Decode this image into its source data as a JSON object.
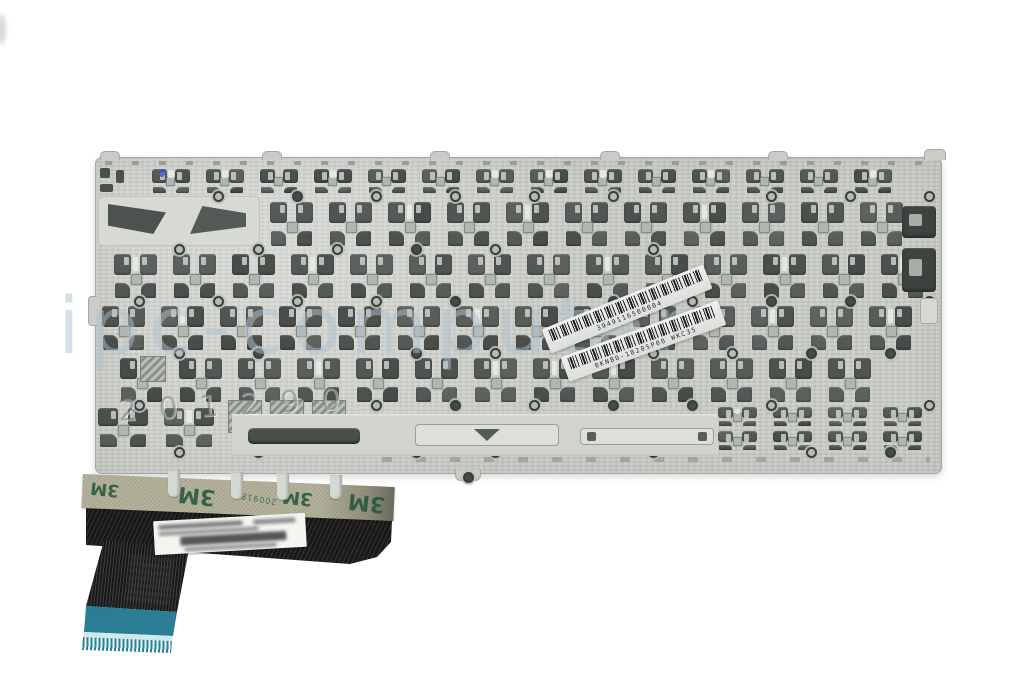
{
  "photo": {
    "subject": "Rear metal backplate of a laptop replacement keyboard with adhesive strips and flex ribbon cable",
    "background": "#ffffff"
  },
  "watermark": {
    "text": "ipc-computer"
  },
  "plate": {
    "stamp": "2 0 1 2    9 0",
    "color": "#cbcec9"
  },
  "stickers": {
    "top_barcode": {
      "code": "3949116500004"
    },
    "part_barcode": {
      "code": "0KNB0-1820SP00  WKC35"
    }
  },
  "adhesive_tape": {
    "brand": "3M",
    "batch_code": "200918",
    "color": "#a9a68f"
  },
  "cable": {
    "connector_color": "#2c8196"
  }
}
